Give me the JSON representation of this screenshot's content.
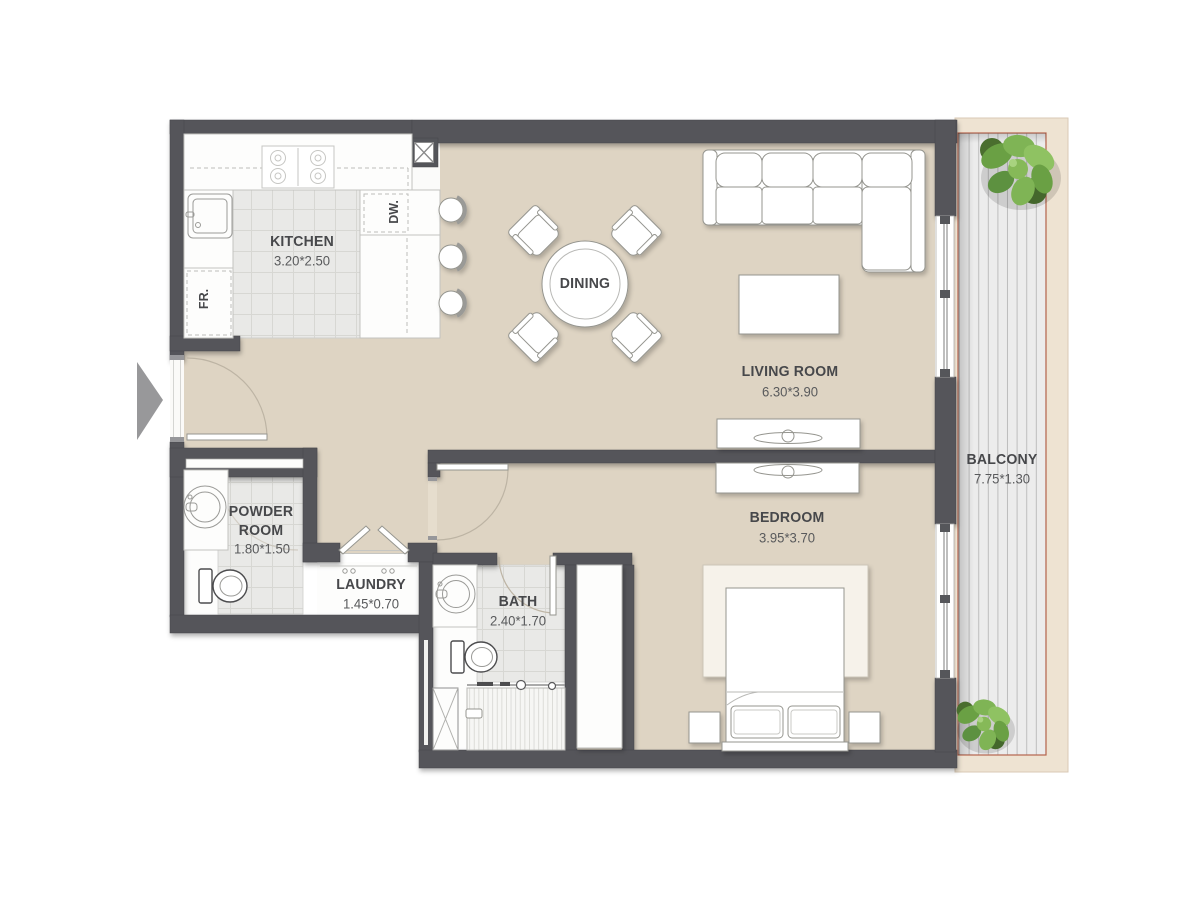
{
  "title": "Apartment Floor Plan",
  "rooms": {
    "kitchen": {
      "name": "KITCHEN",
      "dims": "3.20*2.50"
    },
    "dining": {
      "name": "DINING"
    },
    "living": {
      "name": "LIVING ROOM",
      "dims": "6.30*3.90"
    },
    "bedroom": {
      "name": "BEDROOM",
      "dims": "3.95*3.70"
    },
    "powder": {
      "line1": "POWDER",
      "line2": "ROOM",
      "dims": "1.80*1.50"
    },
    "laundry": {
      "name": "LAUNDRY",
      "dims": "1.45*0.70"
    },
    "bath": {
      "name": "BATH",
      "dims": "2.40*1.70"
    },
    "balcony": {
      "name": "BALCONY",
      "dims": "7.75*1.30"
    }
  },
  "appliances": {
    "fridge": "FR.",
    "dishwasher": "DW."
  },
  "colors": {
    "wall": "#54555a",
    "floor_beige": "#ded4c3",
    "tile": "#e9e9e7",
    "balcony_deck": "#ececec",
    "balcony_trim_red": "#b5654e",
    "balcony_surround": "#eee3d2",
    "furniture_outline": "#95958f",
    "label_text": "#47484b",
    "plant_green": "#7fb455"
  }
}
